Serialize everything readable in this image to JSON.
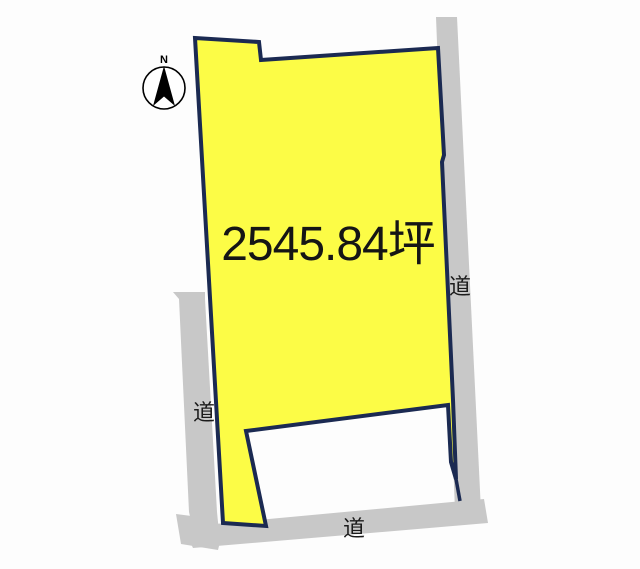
{
  "parcel": {
    "area_label": "2545.84坪"
  },
  "roads": {
    "left_label": "道",
    "right_label": "道",
    "bottom_label": "道"
  },
  "compass": {
    "north_label": "N"
  },
  "colors": {
    "background": "#fdfdfd",
    "parcel_fill": "#fcfc46",
    "parcel_stroke": "#1b2a52",
    "road_fill": "#c8c8c8",
    "area_label_color": "#151515",
    "road_label_color": "#1b1b1b",
    "compass_color": "#000000"
  }
}
